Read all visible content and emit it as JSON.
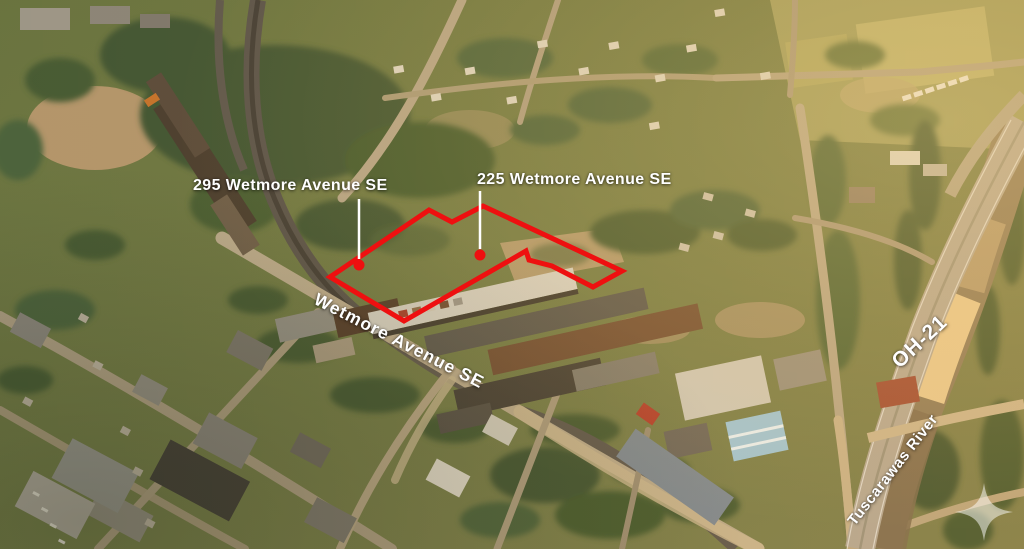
{
  "annotations": {
    "property_295": {
      "label": "295 Wetmore Avenue SE"
    },
    "property_225": {
      "label": "225 Wetmore Avenue SE"
    },
    "street": {
      "label": "Wetmore Avenue SE"
    },
    "highway": {
      "label": "OH-21"
    },
    "river": {
      "label": "Tuscarawas River"
    }
  },
  "colors": {
    "parcel_outline": "#ee1010",
    "marker": "#ee1010",
    "leader": "#ffffff",
    "annotation_text": "#ffffff"
  }
}
